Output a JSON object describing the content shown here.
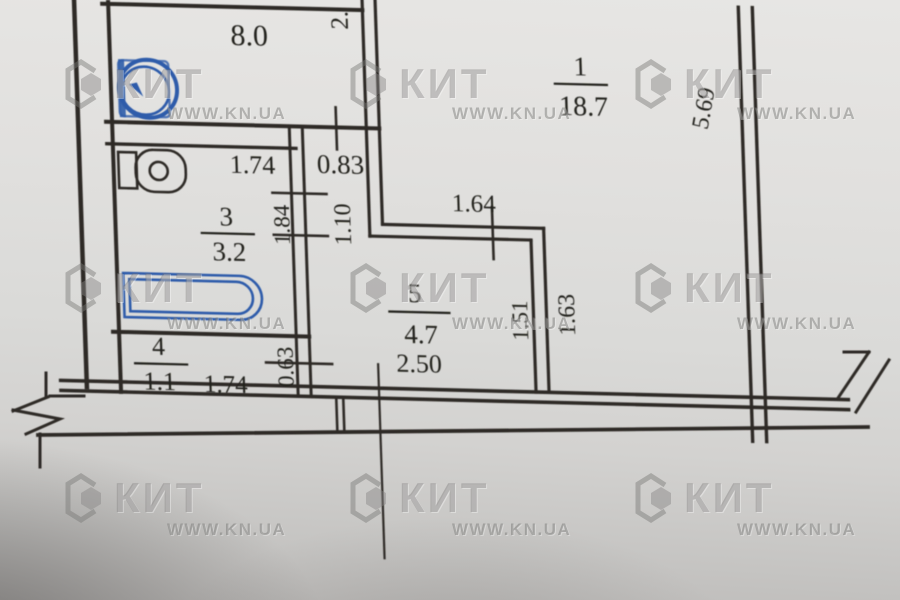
{
  "watermark": {
    "brand": "КИТ",
    "site": "WWW.KN.UA"
  },
  "rooms": {
    "room1": {
      "number": "1",
      "area": "18.7"
    },
    "kitchen": {
      "area": "8.0"
    },
    "room3": {
      "number": "3",
      "area": "3.2"
    },
    "room4": {
      "number": "4",
      "area": "1.1"
    },
    "room5": {
      "number": "5",
      "area": "4.7"
    }
  },
  "dimensions": {
    "kitchen_width_partial": "2.",
    "niche_width": "0.83",
    "niche_depth": "1.10",
    "bathroom_width": "1.74",
    "bathroom_depth": "1.84",
    "room1_inner_width": "1.64",
    "room1_side_depth": "5.69",
    "room1_lower_depth": "1.63",
    "hall_depth": "1.51",
    "hall_width": "2.50",
    "room4_width": "1.74",
    "room4_depth": "0.63"
  },
  "colors": {
    "ink_blue": "#2e5caa",
    "line": "#2e2b26",
    "paper": "#dadad8"
  }
}
